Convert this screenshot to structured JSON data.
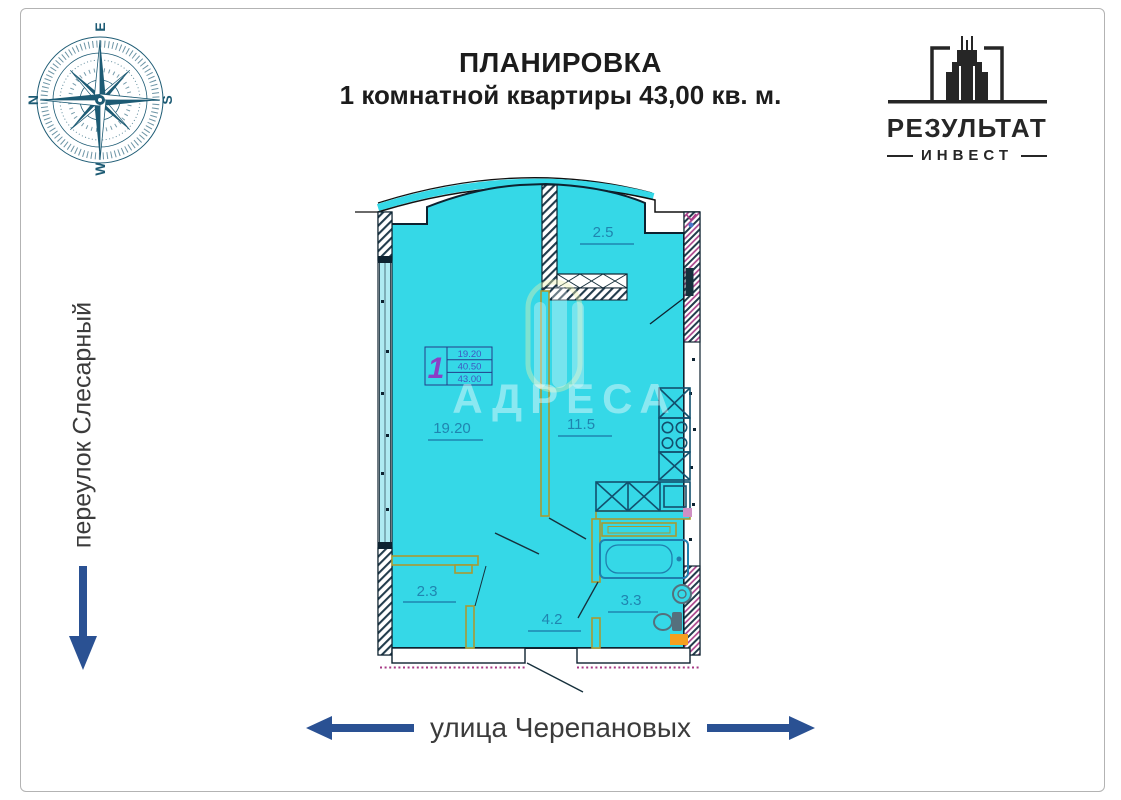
{
  "header": {
    "title_line1": "ПЛАНИРОВКА",
    "title_line2": "1 комнатной квартиры 43,00 кв. м."
  },
  "compass": {
    "top": "E",
    "right": "S",
    "bottom": "W",
    "left": "N"
  },
  "logo": {
    "name": "РЕЗУЛЬТАТ",
    "subname": "ИНВЕСТ"
  },
  "streets": {
    "left": "переулок Слесарный",
    "bottom": "улица Черепановых"
  },
  "plan": {
    "watermark": "АДРЕСА",
    "stamp": {
      "room_count": "1",
      "rows": [
        "19.20",
        "40.50",
        "43.00"
      ]
    },
    "rooms": [
      {
        "name": "living-room",
        "area": "19.20"
      },
      {
        "name": "kitchen",
        "area": "11.5"
      },
      {
        "name": "balcony",
        "area": "2.5"
      },
      {
        "name": "closet",
        "area": "2.3"
      },
      {
        "name": "hallway",
        "area": "4.2"
      },
      {
        "name": "bathroom",
        "area": "3.3"
      }
    ]
  },
  "colors": {
    "floor": "#35d8e7",
    "wall": "#0d2230",
    "partition": "#a89a33",
    "room_label": "#1f85b0",
    "arrow": "#2a5193",
    "magenta": "#a73a86",
    "orange": "#f59f1f",
    "stamp_accent": "#8b3fc6",
    "stamp_value": "#3f57c2",
    "compass": "#1d5b74"
  }
}
